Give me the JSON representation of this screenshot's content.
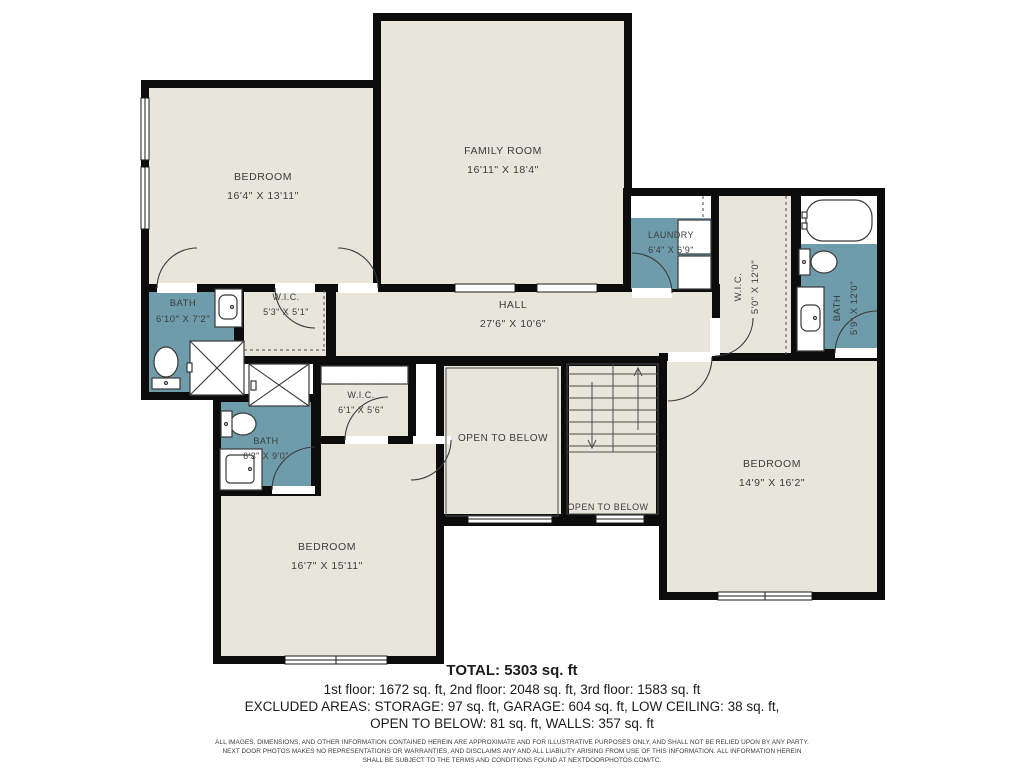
{
  "plan": {
    "colors": {
      "room_fill": "#e8e5da",
      "bath_fill": "#6f9cab",
      "wall": "#0c0c0c"
    },
    "rooms": {
      "bedroom_top_left": {
        "name": "BEDROOM",
        "dims": "16'4\" X 13'11\""
      },
      "family_room": {
        "name": "FAMILY ROOM",
        "dims": "16'11\" X 18'4\""
      },
      "laundry": {
        "name": "LAUNDRY",
        "dims": "6'4\" X 6'9\""
      },
      "wic_right": {
        "name": "W.I.C.",
        "dims": "5'0\" X 12'0\""
      },
      "bath_top_right": {
        "name": "BATH",
        "dims": "5'9\" X 12'0\""
      },
      "hall": {
        "name": "HALL",
        "dims": "27'6\" X 10'6\""
      },
      "bath_left": {
        "name": "BATH",
        "dims": "6'10\" X 7'2\""
      },
      "wic_small": {
        "name": "W.I.C.",
        "dims": "5'3\" X 5'1\""
      },
      "wic_mid": {
        "name": "W.I.C.",
        "dims": "6'1\" X 5'6\""
      },
      "bath_mid": {
        "name": "BATH",
        "dims": "6'3\" X 9'0\""
      },
      "open_to_below": {
        "name": "OPEN TO BELOW"
      },
      "open_to_below_small": {
        "name": "OPEN TO BELOW"
      },
      "bedroom_right": {
        "name": "BEDROOM",
        "dims": "14'9\" X 16'2\""
      },
      "bedroom_bottom": {
        "name": "BEDROOM",
        "dims": "16'7\" X 15'11\""
      }
    }
  },
  "summary": {
    "total": "TOTAL: 5303 sq. ft",
    "floors": "1st floor: 1672 sq. ft, 2nd floor: 2048 sq. ft, 3rd floor: 1583 sq. ft",
    "excluded_line1": "EXCLUDED AREAS: STORAGE: 97 sq. ft, GARAGE: 604 sq. ft, LOW CEILING: 38 sq. ft,",
    "excluded_line2": "OPEN TO BELOW: 81 sq. ft, WALLS: 357 sq. ft"
  },
  "disclaimer": {
    "line1": "ALL IMAGES, DIMENSIONS, AND OTHER INFORMATION CONTAINED HEREIN ARE APPROXIMATE AND FOR ILLUSTRATIVE PURPOSES ONLY, AND SHALL NOT BE RELIED UPON BY ANY PARTY.",
    "line2": "NEXT DOOR PHOTOS MAKES NO REPRESENTATIONS OR WARRANTIES, AND DISCLAIMS ANY AND ALL LIABILITY ARISING FROM USE OF THIS INFORMATION. ALL INFORMATION HEREIN",
    "line3": "SHALL BE SUBJECT TO THE TERMS AND CONDITIONS FOUND AT NEXTDOORPHOTOS.COM/TC."
  }
}
